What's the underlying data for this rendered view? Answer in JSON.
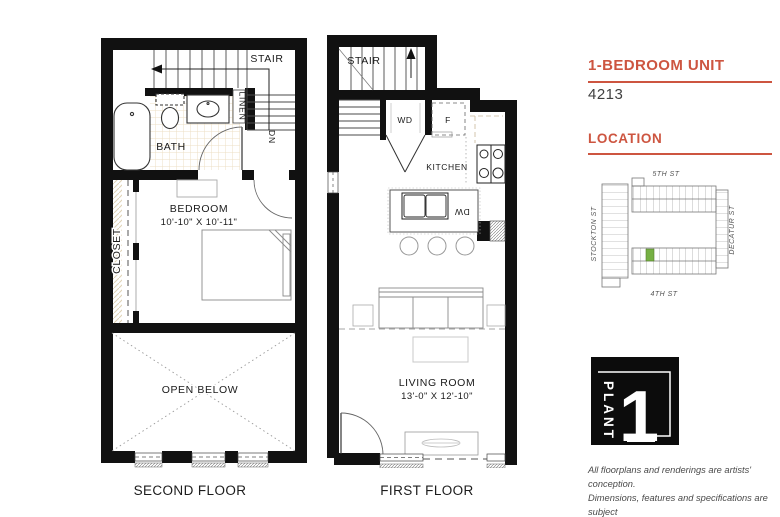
{
  "panel": {
    "unit_type_label": "1-BEDROOM UNIT",
    "unit_number": "4213",
    "location_label": "LOCATION",
    "accent_color": "#cd5540",
    "map": {
      "street_top": "5TH ST",
      "street_bottom": "4TH ST",
      "street_left": "STOCKTON ST",
      "street_right": "DECATUR ST",
      "highlight_color": "#76b043"
    },
    "logo": {
      "brand": "PLANT",
      "number": "1"
    },
    "disclaimer_lines": [
      "All floorplans and renderings are artists' conception.",
      "Dimensions, features and specifications are subject",
      "to change at the discretion of the builder."
    ]
  },
  "second_floor": {
    "caption": "SECOND FLOOR",
    "labels": {
      "stair": "STAIR",
      "dn": "DN",
      "linen": "LINEN",
      "bath": "BATH",
      "bedroom": "BEDROOM",
      "bedroom_dims": "10'-10\" X 10'-11\"",
      "closet": "CLOSET",
      "open_below": "OPEN BELOW"
    }
  },
  "first_floor": {
    "caption": "FIRST FLOOR",
    "labels": {
      "stair": "STAIR",
      "wd": "WD",
      "fridge": "F",
      "kitchen": "KITCHEN",
      "dw": "DW",
      "living_room": "LIVING ROOM",
      "living_room_dims": "13'-0\" X 12'-10\""
    }
  }
}
